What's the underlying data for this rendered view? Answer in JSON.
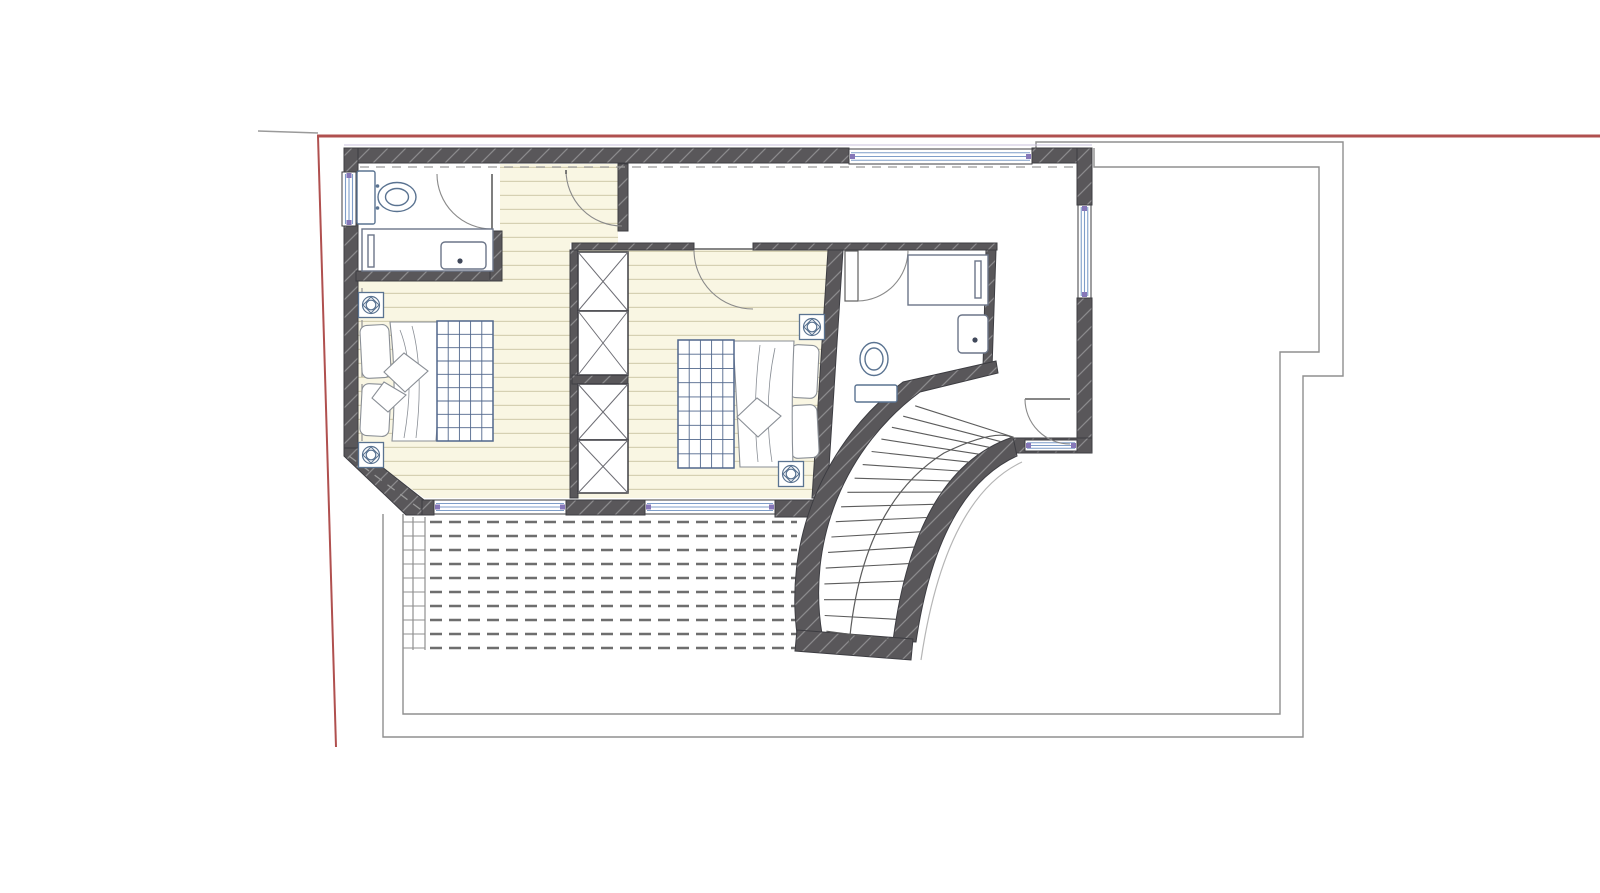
{
  "title": "Upper floor plan with curved staircase",
  "drawing": {
    "kind": "architectural floor plan",
    "view": "top-down",
    "labels_visible": false
  },
  "colors": {
    "paper": "#ffffff",
    "wall": "#59575a",
    "wall_hatch": "rgba(255,255,255,0.30)",
    "wall_frame": "#3d3d42",
    "parquet_bg": "#f9f6e3",
    "parquet_line": "#d5d0b2",
    "fixture": "#5a7391",
    "furniture_line": "#8a8f96",
    "blanket_grid": "#51678c",
    "window_glass": "#7f9ec9",
    "window_cap": "#8677b8",
    "boundary_red": "#b0504f",
    "outline_gray": "#8f8f8f",
    "terrace_dash": "#6e6e6e",
    "door_arc": "#8a8a8a",
    "door_leaf": "#5f5f5f",
    "overhang_dash": "#9a9a9a",
    "lintel_line": "#c9c2dd",
    "stair_line": "#5c5c5c"
  },
  "site": {
    "boundary_line": "red property boundary, top edge and slanted left edge",
    "lower_floor_outline": "thin gray stepped outline of floor below, right and bottom"
  },
  "rooms": [
    {
      "name": "bedroom-1",
      "floor": "parquet",
      "contents": [
        "double-bed",
        "two-pillows",
        "checkered-blanket",
        "throw-cushion",
        "spotlight-symbol-x2"
      ]
    },
    {
      "name": "bathroom-1",
      "floor": "plain",
      "contents": [
        "toilet",
        "bathtub",
        "washbasin",
        "grab-bar"
      ]
    },
    {
      "name": "corridor",
      "floor": "parquet",
      "contents": [
        "door-arc"
      ]
    },
    {
      "name": "bedroom-2",
      "floor": "parquet",
      "contents": [
        "double-bed",
        "two-pillows",
        "checkered-blanket",
        "throw-cushion",
        "built-in-wardrobe",
        "spotlight-symbol-x2"
      ]
    },
    {
      "name": "bathroom-2",
      "floor": "plain",
      "contents": [
        "toilet",
        "shower-vanity",
        "washbasin"
      ]
    },
    {
      "name": "landing",
      "floor": "plain",
      "contents": [
        "curved-staircase",
        "door-arc"
      ]
    },
    {
      "name": "terrace",
      "floor": "decking-dashed",
      "contents": [
        "drainage-channel"
      ]
    }
  ],
  "stair": {
    "type": "curved quarter-turn",
    "tread_lines": 17,
    "walking_line": true
  },
  "terrace": {
    "dash_rows": 10,
    "dash_pattern": [
      12,
      7
    ],
    "row_spacing": 14
  },
  "wardrobe": {
    "cells": 4,
    "symbol": "crossed-diagonals"
  },
  "counts": {
    "windows": 6,
    "door_arcs": 5,
    "spotlights": 4,
    "beds": 2,
    "toilets": 2,
    "washbasins": 2
  }
}
